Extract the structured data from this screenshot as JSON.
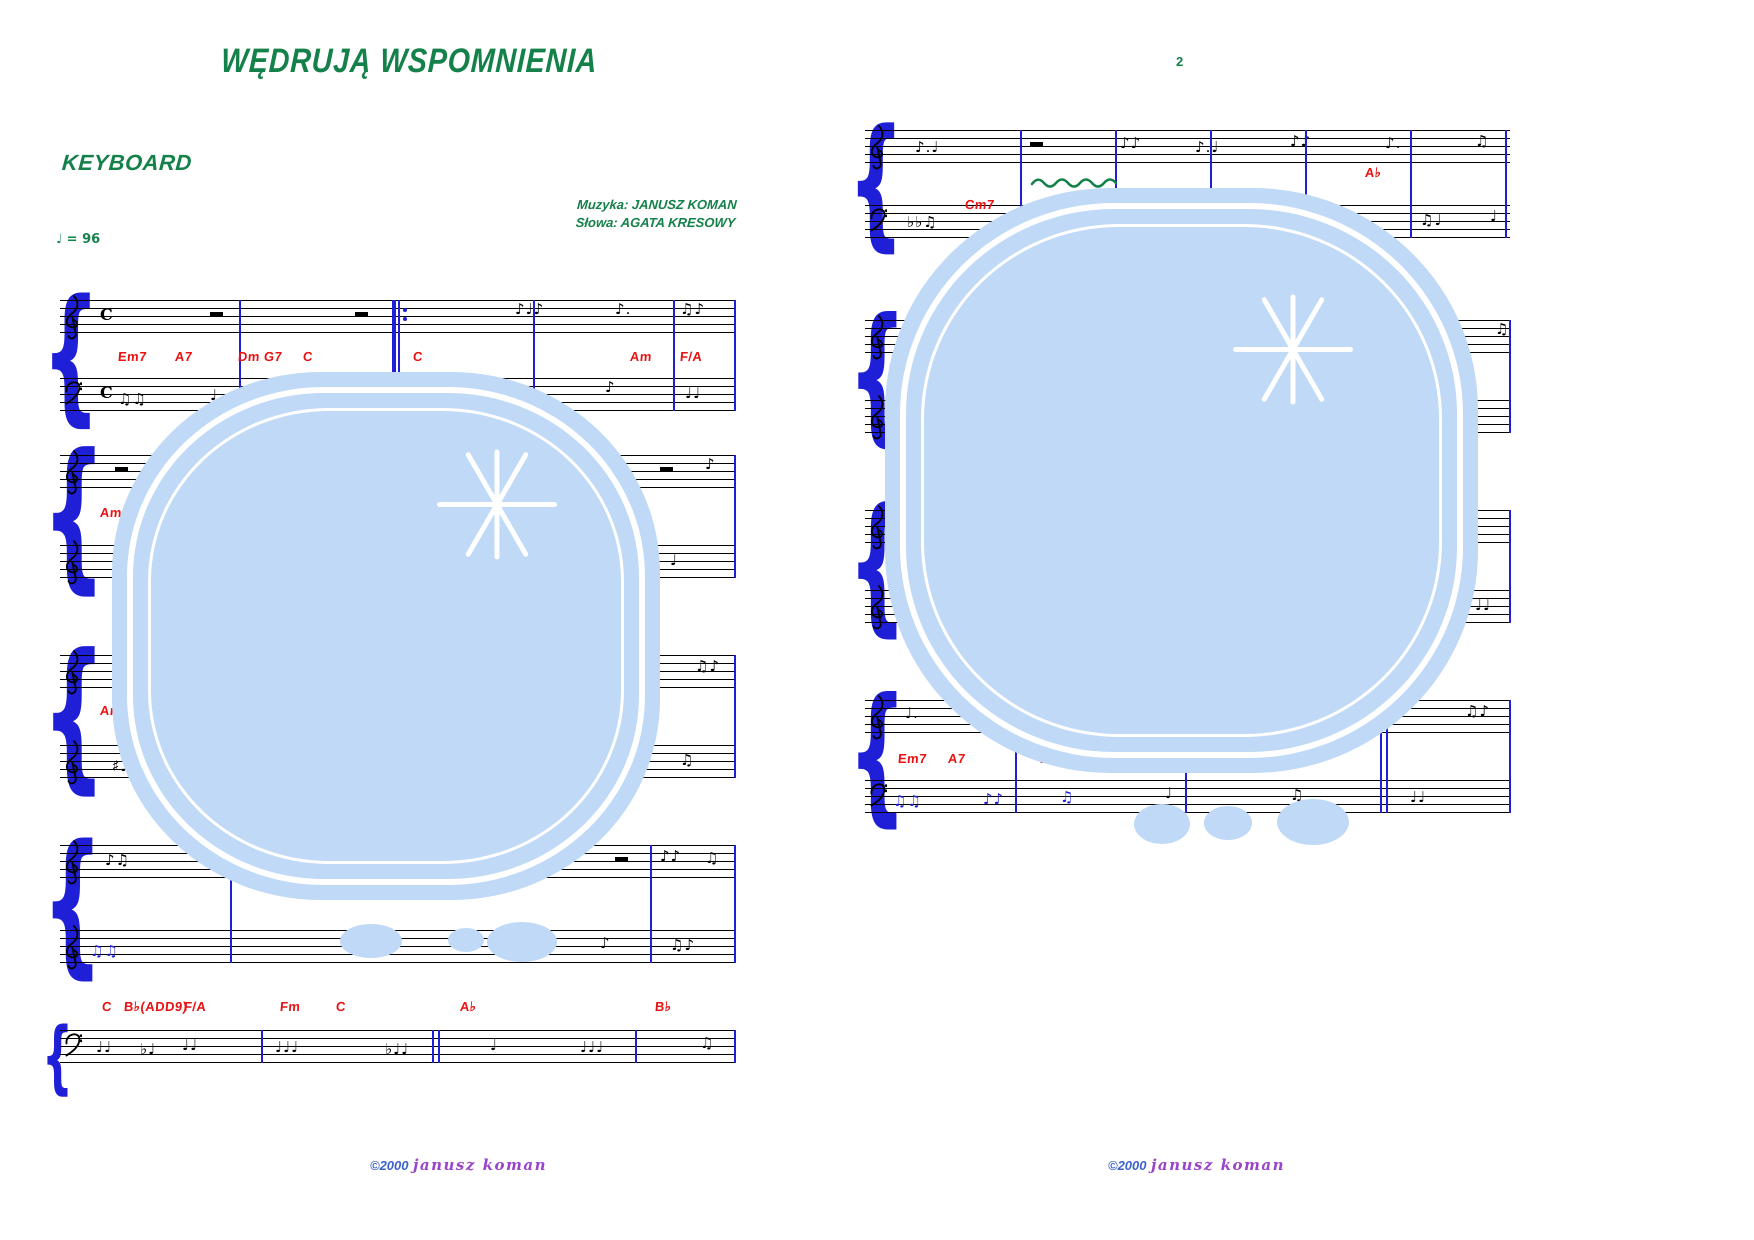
{
  "meta": {
    "title": "WĘDRUJĄ WSPOMNIENIA",
    "instrument": "KEYBOARD",
    "tempo": "♩ = 96",
    "credit_music": "Muzyka: JANUSZ KOMAN",
    "credit_lyrics": "Słowa: AGATA KRESOWY",
    "page2_number": "2",
    "copyright_year": "©2000",
    "copyright_name": "janusz koman"
  },
  "colors": {
    "green": "#15814a",
    "red": "#e81212",
    "blue": "#1f1fd8",
    "stamp_blue": "#bfd9f6",
    "copyright_blue": "#3c63cc",
    "copyright_purple": "#9a44cc"
  },
  "pages": [
    {
      "name": "page-1",
      "staff_x": 60,
      "staff_w": 675,
      "brace_x": 42,
      "systems": [
        {
          "brace": {
            "top": 296,
            "h": 116
          },
          "bar_top": 300,
          "bar_h": 111,
          "staves": [
            {
              "y": 300,
              "clef": "treble",
              "notes": [
                {
                  "x": 40,
                  "t": "sig"
                },
                {
                  "x": 150,
                  "t": "rest"
                },
                {
                  "x": 295,
                  "t": "rest"
                },
                {
                  "x": 455,
                  "g": "♪♩♪"
                },
                {
                  "x": 555,
                  "g": "♪."
                },
                {
                  "x": 620,
                  "g": "♫♪"
                }
              ]
            },
            {
              "y": 378,
              "clef": "bass",
              "notes": [
                {
                  "x": 40,
                  "t": "sig"
                },
                {
                  "x": 58,
                  "g": "♫♫",
                  "dy": 12
                },
                {
                  "x": 150,
                  "g": "♩",
                  "dy": 8
                },
                {
                  "x": 235,
                  "g": "♫",
                  "dy": 6
                },
                {
                  "x": 330,
                  "g": "♪",
                  "dy": 4
                },
                {
                  "x": 425,
                  "g": "♩.",
                  "dy": 2
                },
                {
                  "x": 545,
                  "g": "♪",
                  "dy": 0
                },
                {
                  "x": 625,
                  "g": "♩♩",
                  "dy": 6
                }
              ]
            }
          ],
          "barlines": [
            {
              "x": 179
            },
            {
              "x": 332,
              "t": "repeat"
            },
            {
              "x": 473
            },
            {
              "x": 613
            },
            {
              "x": 674
            }
          ],
          "chords": [
            {
              "t": "Em7",
              "x": 58,
              "y": 349
            },
            {
              "t": "A7",
              "x": 115,
              "y": 349
            },
            {
              "t": "Dm",
              "x": 178,
              "y": 349
            },
            {
              "t": "G7",
              "x": 204,
              "y": 349
            },
            {
              "t": "C",
              "x": 243,
              "y": 349
            },
            {
              "t": "C",
              "x": 353,
              "y": 349
            },
            {
              "t": "Am",
              "x": 570,
              "y": 349
            },
            {
              "t": "F/A",
              "x": 620,
              "y": 349
            }
          ]
        },
        {
          "brace": {
            "top": 451,
            "h": 127
          },
          "bar_top": 455,
          "bar_h": 123,
          "staves": [
            {
              "y": 455,
              "clef": "treble",
              "notes": [
                {
                  "x": 55,
                  "t": "rest"
                },
                {
                  "x": 200,
                  "g": "♪♩"
                },
                {
                  "x": 430,
                  "g": "♫"
                },
                {
                  "x": 600,
                  "t": "rest"
                },
                {
                  "x": 645,
                  "g": "♪"
                }
              ]
            },
            {
              "y": 545,
              "clef": "treble",
              "notes": [
                {
                  "x": 52,
                  "g": "♯♫",
                  "dy": 12
                },
                {
                  "x": 200,
                  "g": "♩",
                  "dy": 8
                },
                {
                  "x": 430,
                  "g": "♫♪",
                  "dy": 4
                },
                {
                  "x": 610,
                  "g": "♩",
                  "dy": 6
                }
              ]
            }
          ],
          "barlines": [
            {
              "x": 160
            },
            {
              "x": 370
            },
            {
              "x": 550
            },
            {
              "x": 674
            }
          ],
          "chords": [
            {
              "t": "Am",
              "x": 40,
              "y": 505
            }
          ]
        },
        {
          "brace": {
            "top": 651,
            "h": 127
          },
          "bar_top": 655,
          "bar_h": 123,
          "staves": [
            {
              "y": 655,
              "clef": "treble",
              "notes": [
                {
                  "x": 60,
                  "g": "♩",
                  "dy": 4
                },
                {
                  "x": 250,
                  "g": "♫"
                },
                {
                  "x": 530,
                  "g": "♪♩"
                },
                {
                  "x": 635,
                  "g": "♫♪",
                  "dy": 2
                }
              ]
            },
            {
              "y": 745,
              "clef": "treble",
              "notes": [
                {
                  "x": 52,
                  "g": "♯♩♫",
                  "dy": 12
                },
                {
                  "x": 230,
                  "g": "♪",
                  "dy": 6
                },
                {
                  "x": 480,
                  "g": "♩",
                  "dy": 4
                },
                {
                  "x": 620,
                  "g": "♫",
                  "dy": 6
                }
              ]
            }
          ],
          "barlines": [
            {
              "x": 170
            },
            {
              "x": 390
            },
            {
              "x": 560
            },
            {
              "x": 674
            }
          ],
          "chords": [
            {
              "t": "Am",
              "x": 40,
              "y": 703
            }
          ]
        },
        {
          "brace": {
            "top": 841,
            "h": 122
          },
          "bar_top": 845,
          "bar_h": 118,
          "staves": [
            {
              "y": 845,
              "clef": "treble",
              "notes": [
                {
                  "x": 45,
                  "g": "♪♫",
                  "dy": 6
                },
                {
                  "x": 150,
                  "g": "♩",
                  "dy": 2
                },
                {
                  "x": 555,
                  "t": "rest"
                },
                {
                  "x": 600,
                  "g": "♪♪",
                  "dy": 2
                },
                {
                  "x": 645,
                  "g": "♫",
                  "dy": 4
                }
              ]
            },
            {
              "y": 930,
              "clef": "treble",
              "notes": [
                {
                  "x": 30,
                  "g": "♫♫",
                  "c": "blue",
                  "dy": 12
                },
                {
                  "x": 540,
                  "g": "♪",
                  "dy": 4
                },
                {
                  "x": 610,
                  "g": "♫♪",
                  "dy": 6
                }
              ]
            }
          ],
          "barlines": [
            {
              "x": 170
            },
            {
              "x": 590
            },
            {
              "x": 674
            }
          ],
          "chords": []
        },
        {
          "brace": {
            "top": 1026,
            "h": 62
          },
          "bar_top": 1030,
          "bar_h": 33,
          "staves": [
            {
              "y": 1030,
              "clef": "bass",
              "notes": [
                {
                  "x": 36,
                  "g": "♩♩",
                  "dy": 8
                },
                {
                  "x": 80,
                  "g": "♭♩",
                  "dy": 10
                },
                {
                  "x": 122,
                  "g": "♩♩",
                  "dy": 6
                },
                {
                  "x": 215,
                  "g": "♩♩♩",
                  "dy": 8
                },
                {
                  "x": 325,
                  "g": "♭♩♩",
                  "dy": 10
                },
                {
                  "x": 430,
                  "g": "♩",
                  "dy": 6
                },
                {
                  "x": 520,
                  "g": "♩♩♩",
                  "dy": 8
                },
                {
                  "x": 640,
                  "g": "♫",
                  "dy": 4
                }
              ]
            }
          ],
          "barlines": [
            {
              "x": 201
            },
            {
              "x": 372,
              "t": "double"
            },
            {
              "x": 575
            },
            {
              "x": 674
            }
          ],
          "chords": [
            {
              "t": "C",
              "x": 42,
              "y": 999
            },
            {
              "t": "B♭(ADD9)",
              "x": 64,
              "y": 999
            },
            {
              "t": "F/A",
              "x": 124,
              "y": 999
            },
            {
              "t": "Fm",
              "x": 220,
              "y": 999
            },
            {
              "t": "C",
              "x": 276,
              "y": 999
            },
            {
              "t": "A♭",
              "x": 400,
              "y": 999
            },
            {
              "t": "B♭",
              "x": 595,
              "y": 999
            }
          ]
        }
      ]
    },
    {
      "name": "page-2",
      "staff_x": 865,
      "staff_w": 645,
      "brace_x": 848,
      "systems": [
        {
          "brace": {
            "top": 126,
            "h": 112
          },
          "bar_top": 130,
          "bar_h": 108,
          "staves": [
            {
              "y": 130,
              "clef": "treble",
              "notes": [
                {
                  "x": 50,
                  "g": "♪.♩",
                  "dy": 8
                },
                {
                  "x": 165,
                  "t": "rest"
                },
                {
                  "x": 255,
                  "g": "♪♪",
                  "dy": 4
                },
                {
                  "x": 330,
                  "g": "♪.♩",
                  "dy": 8
                },
                {
                  "x": 425,
                  "g": "♪♪",
                  "dy": 2
                },
                {
                  "x": 520,
                  "g": "♪.",
                  "dy": 4
                },
                {
                  "x": 610,
                  "g": "♫",
                  "dy": 2
                }
              ]
            },
            {
              "y": 205,
              "clef": "bass",
              "notes": [
                {
                  "x": 42,
                  "g": "♭♭♫",
                  "dy": 8
                },
                {
                  "x": 140,
                  "g": "♩",
                  "dy": 4
                },
                {
                  "x": 260,
                  "g": "♫♪",
                  "dy": 2
                },
                {
                  "x": 430,
                  "g": "♪",
                  "dy": 4
                },
                {
                  "x": 555,
                  "g": "♫♩",
                  "dy": 6
                },
                {
                  "x": 625,
                  "g": "♩",
                  "dy": 2
                }
              ]
            }
          ],
          "barlines": [
            {
              "x": 155
            },
            {
              "x": 250
            },
            {
              "x": 345
            },
            {
              "x": 440
            },
            {
              "x": 545
            },
            {
              "x": 640
            }
          ],
          "chords": [
            {
              "t": "Cm7",
              "x": 100,
              "y": 197
            },
            {
              "t": "A♭",
              "x": 500,
              "y": 165
            }
          ]
        },
        {
          "brace": {
            "top": 316,
            "h": 117
          },
          "bar_top": 320,
          "bar_h": 113,
          "staves": [
            {
              "y": 320,
              "clef": "treble",
              "notes": [
                {
                  "x": 70,
                  "g": "♩",
                  "dy": 2
                },
                {
                  "x": 230,
                  "g": "♫"
                },
                {
                  "x": 540,
                  "g": "♪",
                  "dy": 2
                },
                {
                  "x": 630,
                  "g": "♫"
                }
              ]
            },
            {
              "y": 400,
              "clef": "treble",
              "notes": [
                {
                  "x": 60,
                  "g": "♩",
                  "dy": 8
                },
                {
                  "x": 300,
                  "g": "♪",
                  "dy": 4
                },
                {
                  "x": 600,
                  "g": "♩",
                  "dy": 6
                }
              ]
            }
          ],
          "barlines": [
            {
              "x": 180
            },
            {
              "x": 390
            },
            {
              "x": 560
            },
            {
              "x": 644
            }
          ],
          "chords": []
        },
        {
          "brace": {
            "top": 506,
            "h": 117
          },
          "bar_top": 510,
          "bar_h": 113,
          "staves": [
            {
              "y": 510,
              "clef": "treble",
              "notes": [
                {
                  "x": 65,
                  "g": "♪♩",
                  "dy": 2
                },
                {
                  "x": 280,
                  "g": "♫"
                },
                {
                  "x": 600,
                  "g": "♪",
                  "dy": 4
                }
              ]
            },
            {
              "y": 590,
              "clef": "treble",
              "notes": [
                {
                  "x": 60,
                  "g": "♩",
                  "dy": 8
                },
                {
                  "x": 320,
                  "g": "♫",
                  "dy": 4
                },
                {
                  "x": 610,
                  "g": "♩♩",
                  "dy": 6
                }
              ]
            }
          ],
          "barlines": [
            {
              "x": 170
            },
            {
              "x": 380
            },
            {
              "x": 644
            }
          ],
          "chords": []
        },
        {
          "brace": {
            "top": 696,
            "h": 117
          },
          "bar_top": 700,
          "bar_h": 113,
          "staves": [
            {
              "y": 700,
              "clef": "treble",
              "notes": [
                {
                  "x": 40,
                  "g": "♩.",
                  "dy": 4
                },
                {
                  "x": 120,
                  "g": "♪♩",
                  "dy": 2
                },
                {
                  "x": 250,
                  "g": "♫"
                },
                {
                  "x": 380,
                  "g": "♩",
                  "dy": 2
                },
                {
                  "x": 520,
                  "t": "rest"
                },
                {
                  "x": 600,
                  "g": "♫♪",
                  "dy": 2
                }
              ]
            },
            {
              "y": 780,
              "clef": "bass",
              "notes": [
                {
                  "x": 28,
                  "g": "♫♫",
                  "c": "blue",
                  "dy": 12
                },
                {
                  "x": 118,
                  "g": "♪♪",
                  "c": "blue",
                  "dy": 10
                },
                {
                  "x": 195,
                  "g": "♫",
                  "c": "blue",
                  "dy": 8
                },
                {
                  "x": 300,
                  "g": "♩",
                  "dy": 4
                },
                {
                  "x": 425,
                  "g": "♫",
                  "dy": 6
                },
                {
                  "x": 545,
                  "g": "♩♩",
                  "dy": 8
                }
              ]
            }
          ],
          "barlines": [
            {
              "x": 150
            },
            {
              "x": 320
            },
            {
              "x": 515,
              "t": "double"
            },
            {
              "x": 644
            }
          ],
          "chords": [
            {
              "t": "Em7",
              "x": 33,
              "y": 751
            },
            {
              "t": "A7",
              "x": 83,
              "y": 751
            },
            {
              "t": "Dm7",
              "x": 175,
              "y": 751
            }
          ]
        }
      ]
    }
  ]
}
